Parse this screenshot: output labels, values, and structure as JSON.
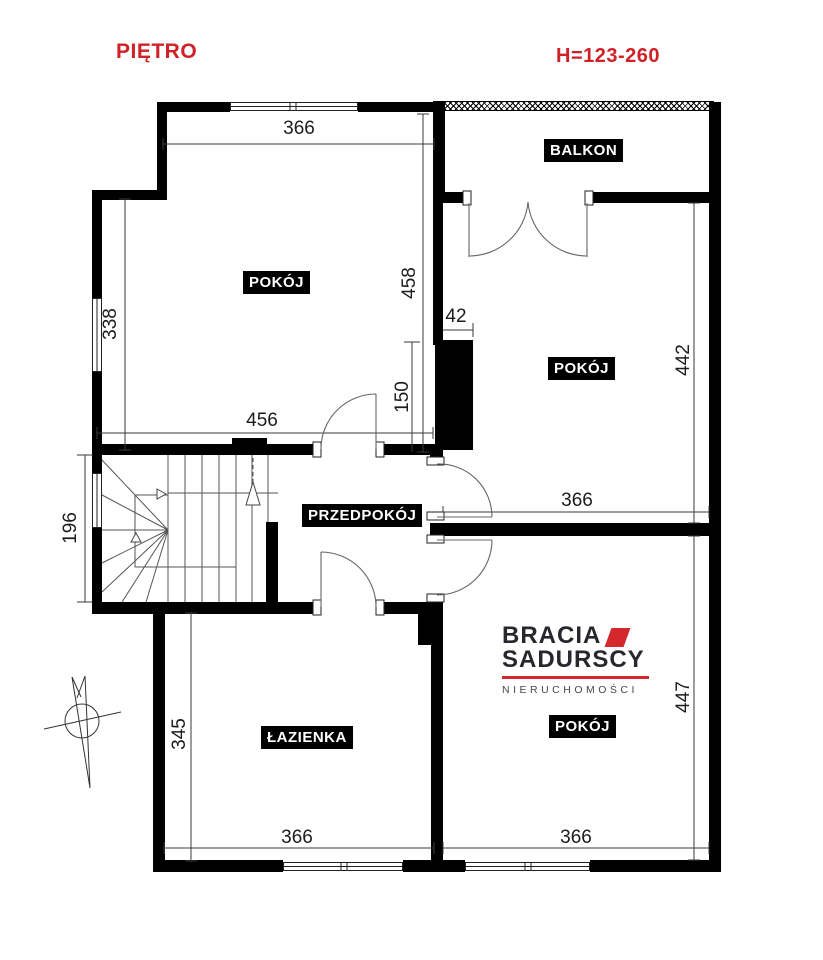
{
  "page": {
    "title": "PIĘTRO",
    "height_label": "H=123-260"
  },
  "colors": {
    "accent_red": "#cf2127",
    "logo_red": "#d5282e",
    "logo_dark": "#27272e",
    "logo_gray": "#47474e",
    "wall": "#000000"
  },
  "rooms": {
    "pokoj_tl": "POKÓJ",
    "balkon": "BALKON",
    "pokoj_tr": "POKÓJ",
    "przedpokoj": "PRZEDPOKÓJ",
    "lazienka": "ŁAZIENKA",
    "pokoj_br": "POKÓJ"
  },
  "dimensions": {
    "top_366": "366",
    "left_338": "338",
    "right_458": "458",
    "right_150": "150",
    "chimney_42": "42",
    "bottom_456": "456",
    "stairs_196": "196",
    "tr_442": "442",
    "mid_366": "366",
    "laz_345": "345",
    "bl_366": "366",
    "br_366": "366",
    "br_447": "447"
  },
  "logo": {
    "line1": "BRACIA",
    "line2": "SADURSCY",
    "line3": "NIERUCHOMOŚCI"
  }
}
